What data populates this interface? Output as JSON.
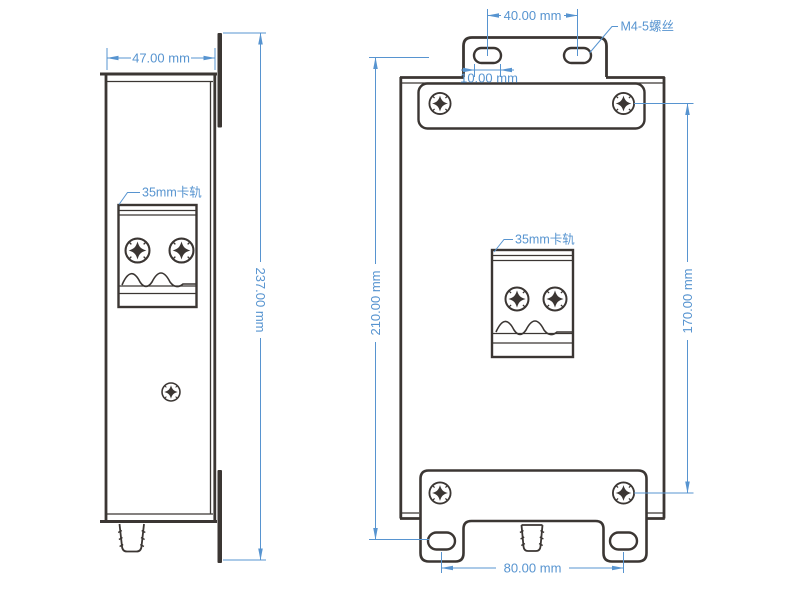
{
  "diagram": {
    "side_view": {
      "width_dim": "47.00 mm",
      "height_dim": "237.00 mm",
      "din_rail_label": "35mm卡轨"
    },
    "front_view": {
      "top_slot_spacing_dim": "40.00 mm",
      "slot_width_dim": "10.00 mm",
      "screw_spec_label": "M4-5螺丝",
      "left_height_dim": "210.00 mm",
      "right_height_dim": "170.00 mm",
      "din_rail_label": "35mm卡轨",
      "bottom_slot_spacing_dim": "80.00 mm"
    },
    "colors": {
      "outline": "#3b3633",
      "dimension": "#5794d0",
      "background": "#ffffff"
    }
  }
}
